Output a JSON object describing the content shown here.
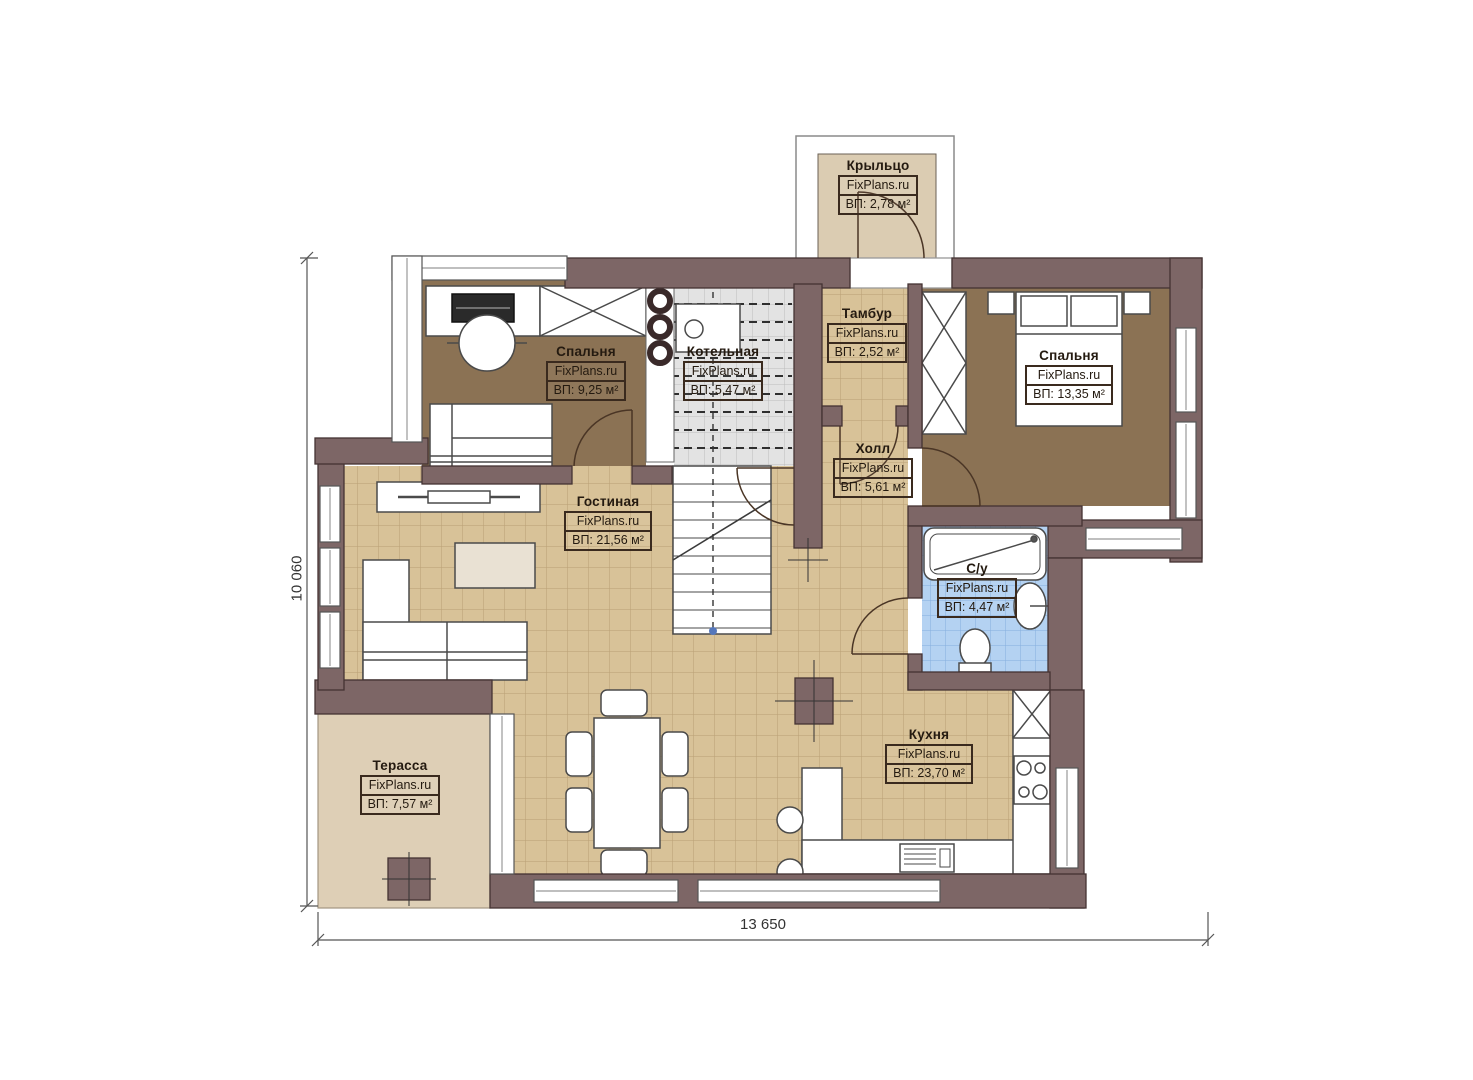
{
  "brand": "FixPlans.ru",
  "dimensions": {
    "height": "10 060",
    "width": "13 650"
  },
  "rooms": [
    {
      "id": "porch",
      "name": "Крыльцо",
      "brand": "FixPlans.ru",
      "area": "ВП: 2,78 м²"
    },
    {
      "id": "bedroom1",
      "name": "Спальня",
      "brand": "FixPlans.ru",
      "area": "ВП: 9,25 м²"
    },
    {
      "id": "boiler",
      "name": "Котельная",
      "brand": "FixPlans.ru",
      "area": "ВП: 5,47 м²"
    },
    {
      "id": "tambour",
      "name": "Тамбур",
      "brand": "FixPlans.ru",
      "area": "ВП: 2,52 м²"
    },
    {
      "id": "bedroom2",
      "name": "Спальня",
      "brand": "FixPlans.ru",
      "area": "ВП: 13,35 м²"
    },
    {
      "id": "hall",
      "name": "Холл",
      "brand": "FixPlans.ru",
      "area": "ВП: 5,61 м²"
    },
    {
      "id": "living",
      "name": "Гостиная",
      "brand": "FixPlans.ru",
      "area": "ВП: 21,56 м²"
    },
    {
      "id": "bathroom",
      "name": "С/у",
      "brand": "FixPlans.ru",
      "area": "ВП: 4,47 м²"
    },
    {
      "id": "kitchen",
      "name": "Кухня",
      "brand": "FixPlans.ru",
      "area": "ВП: 23,70 м²"
    },
    {
      "id": "terrace",
      "name": "Терасса",
      "brand": "FixPlans.ru",
      "area": "ВП: 7,57 м²"
    }
  ],
  "colors": {
    "wall": "#7d6666",
    "wall_outline": "#443333",
    "floor_tile_beige": "#d8c298",
    "floor_brown": "#8b7254",
    "floor_tile_gray": "#e3e3e3",
    "floor_tile_blue": "#b4d2f2",
    "terrace_floor": "#decfb6",
    "furniture": "#ffffff"
  }
}
